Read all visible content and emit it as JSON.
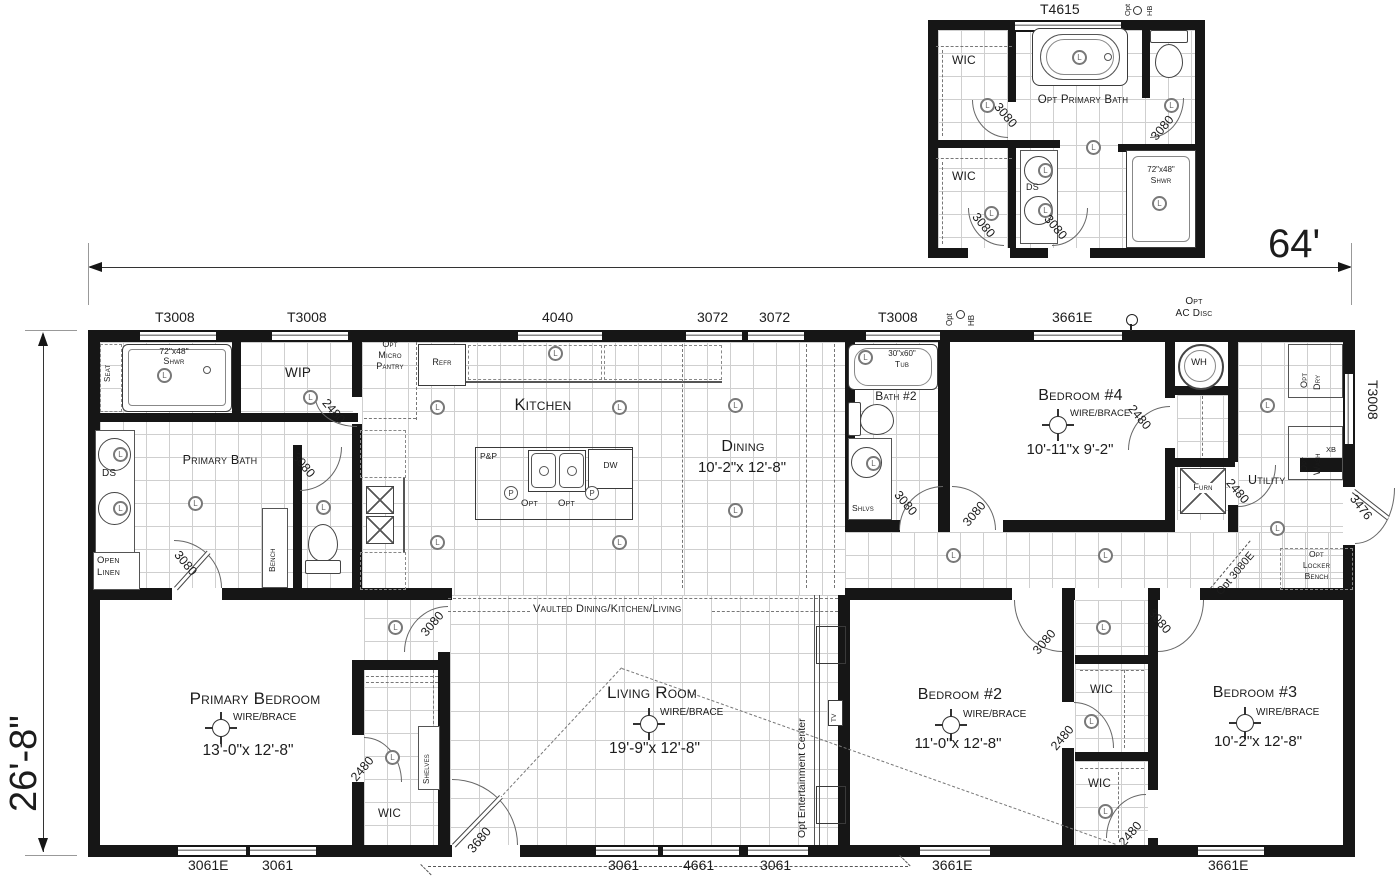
{
  "glyphs": {
    "light": "L",
    "pendant": "P"
  },
  "dims": {
    "width": "64'",
    "depth": "26'-8\""
  },
  "inset": {
    "title": "Opt Primary Bath",
    "window": "T4615",
    "opt": "Opt",
    "hb": "HB",
    "wic_upper": "WIC",
    "wic_lower": "WIC",
    "ds": "DS",
    "shower_size": "72\"x48\"",
    "shower": "Shwr",
    "door_wic_upper": "3080",
    "door_bath_right": "3080",
    "door_wic_lower": "3080",
    "door_bath_bottom": "3080"
  },
  "top": {
    "w1": "T3008",
    "w2": "T3008",
    "w3": "4040",
    "w4": "3072",
    "w5": "3072",
    "w6": "T3008",
    "opt": "Opt",
    "hb": "HB",
    "w7": "3661E",
    "ac1": "Opt",
    "ac2": "AC Disc"
  },
  "bottom": {
    "w1": "3061E",
    "w2": "3061",
    "w3": "3061",
    "w4": "4661",
    "w5": "3061",
    "w6": "3661E",
    "w7": "3661E"
  },
  "right": {
    "window": "T3008",
    "door": "3476",
    "xb": "XB"
  },
  "suite": {
    "shower_size": "72\"x48\"",
    "shower": "Shwr",
    "seat": "Seat",
    "wip": "WIP",
    "wip_door": "2480",
    "bath": "Primary Bath",
    "ds": "DS",
    "linen1": "Open",
    "linen2": "Linen",
    "bench": "Bench",
    "alcove_door": "3080",
    "bed_door": "3080"
  },
  "kitchen": {
    "name": "Kitchen",
    "refr": "Refr",
    "m1": "Opt",
    "m2": "Micro",
    "m3": "Pantry",
    "pp": "P&P",
    "dw": "DW",
    "opt1": "Opt",
    "opt2": "Opt"
  },
  "dining": {
    "name": "Dining",
    "size": "10'-2\"x 12'-8\""
  },
  "bath2": {
    "name": "Bath #2",
    "tub_size": "30\"x60\"",
    "tub": "Tub",
    "shlvs": "Shlvs",
    "door": "3080"
  },
  "bed4": {
    "name": "Bedroom #4",
    "wire": "WIRE/BRACE",
    "size": "10'-11\"x 9'-2\"",
    "door": "3080",
    "closet_door": "2480",
    "wh": "WH",
    "furn": "Furn"
  },
  "utility": {
    "name": "Utility",
    "d1": "Opt",
    "d2": "Dry",
    "wa1": "Opt",
    "wa2": "Wash",
    "door": "2480",
    "mud_door": "Opt 3080E",
    "l1": "Opt",
    "l2": "Locker",
    "l3": "Bench"
  },
  "vault": {
    "label": "Vaulted Dining/Kitchen/Living"
  },
  "primary": {
    "name": "Primary Bedroom",
    "wire": "WIRE/BRACE",
    "size": "13'-0\"x 12'-8\"",
    "door": "3080",
    "wic": "WIC",
    "wic_door": "2480",
    "shelves": "Shelves"
  },
  "living": {
    "name": "Living Room",
    "wire": "WIRE/BRACE",
    "size": "19'-9\"x 12'-8\"",
    "door": "3680",
    "ent": "Opt Entertainment Center",
    "tv": "TV"
  },
  "bed2": {
    "name": "Bedroom #2",
    "wire": "WIRE/BRACE",
    "size": "11'-0\"x 12'-8\"",
    "door": "3080",
    "wic": "WIC",
    "wic_door": "2480"
  },
  "bed3": {
    "name": "Bedroom #3",
    "wire": "WIRE/BRACE",
    "size": "10'-2\"x 12'-8\"",
    "door": "3080",
    "wic": "WIC",
    "wic_door": "2480"
  }
}
